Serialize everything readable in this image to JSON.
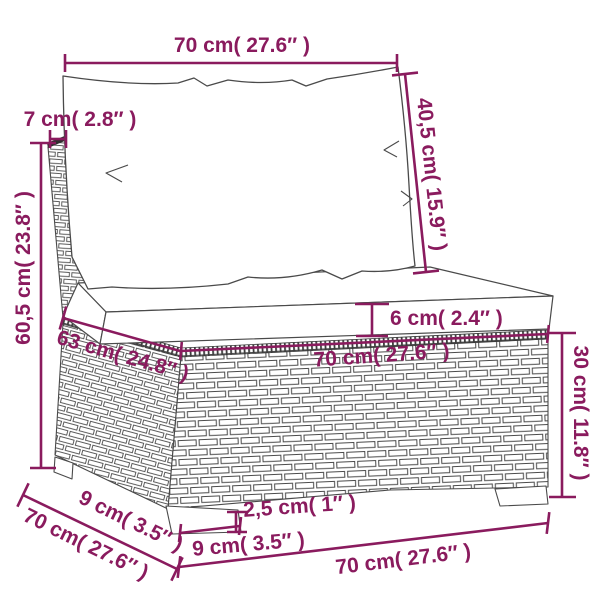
{
  "figure": {
    "subject": "Poly rattan sofa section with back cushion and seat cushion - product dimension diagram",
    "unit_system": "cm with inch conversion"
  },
  "colors": {
    "dimension_color": "#8a1b5e",
    "line_art_color": "#4a4a4a",
    "background": "#ffffff"
  },
  "dimensions": {
    "top_width": "70 cm( 27.6″ )",
    "back_thickness": "7 cm( 2.8″ )",
    "back_cushion_height": "40,5 cm( 15.9″ )",
    "total_height": "60,5 cm( 23.8″ )",
    "seat_cushion_thickness": "6 cm( 2.4″ )",
    "seat_side_depth": "63 cm( 24.8″ )",
    "seat_front_width": "70 cm( 27.6″ )",
    "base_height": "30 cm( 11.8″ )",
    "foot_height": "2,5 cm( 1″ )",
    "foot_width": "9 cm( 3.5″ )",
    "side_foot_offset": "9 cm( 3.5″ )",
    "side_depth": "70 cm( 27.6″ )",
    "bottom_width": "70 cm( 27.6″ )"
  }
}
